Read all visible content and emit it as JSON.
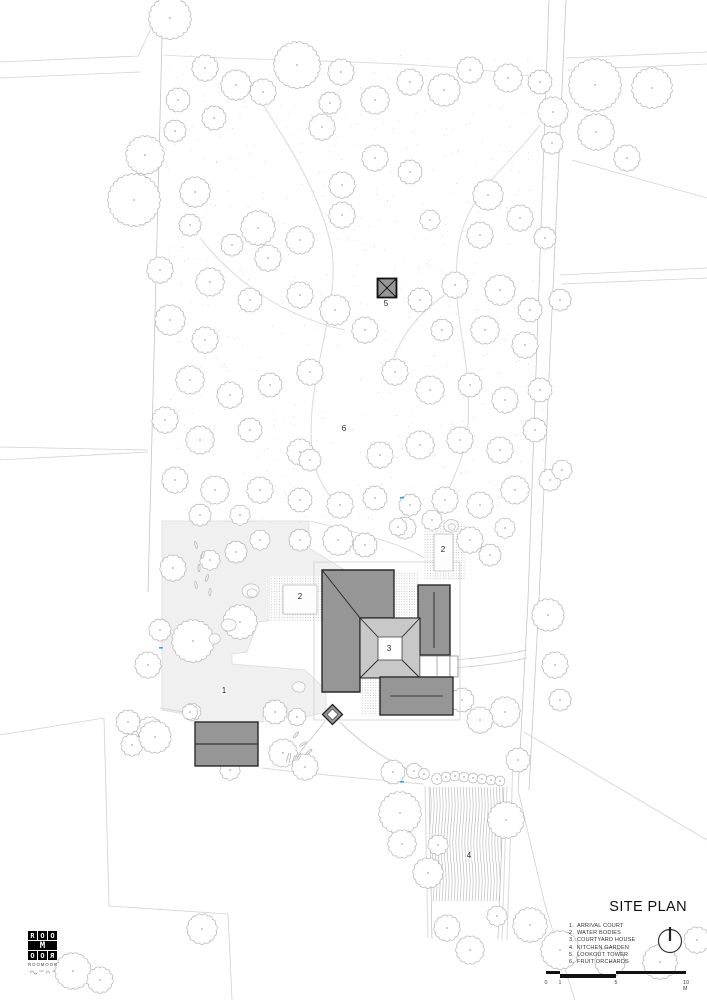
{
  "title_block": {
    "title": "SITE PLAN",
    "legend": [
      {
        "num": "1.",
        "label": "ARRIVAL COURT"
      },
      {
        "num": "2.",
        "label": "WATER BODIES"
      },
      {
        "num": "3.",
        "label": "COURTYARD HOUSE"
      },
      {
        "num": "4.",
        "label": "KITCHEN GARDEN"
      },
      {
        "num": "5.",
        "label": "LOOKOUT TOWER"
      },
      {
        "num": "6.",
        "label": "FRUIT ORCHARDS"
      }
    ],
    "scale_bar": {
      "ticks": [
        {
          "text": "0",
          "x": 0
        },
        {
          "text": "1",
          "x": 14
        },
        {
          "text": "5",
          "x": 70
        },
        {
          "text": "10 M",
          "x": 140
        }
      ]
    },
    "north_icon": "north-indicator"
  },
  "logo": {
    "rows": [
      "ROO",
      "M",
      "OOR"
    ],
    "wordmark": "ROOMOOR"
  },
  "plan": {
    "labels": [
      {
        "text": "1",
        "x": 224,
        "y": 691
      },
      {
        "text": "2",
        "x": 300,
        "y": 597
      },
      {
        "text": "2",
        "x": 443,
        "y": 550
      },
      {
        "text": "3",
        "x": 389,
        "y": 649
      },
      {
        "text": "4",
        "x": 469,
        "y": 856
      },
      {
        "text": "5",
        "x": 386,
        "y": 304
      },
      {
        "text": "6",
        "x": 344,
        "y": 429
      }
    ],
    "colors": {
      "roof_dark": "#ababab",
      "roof_outline": "#2a2a2a",
      "tree_line": "#b5b5b5",
      "context_line": "#d2d2d2",
      "court_fill": "#f0f0f0",
      "survey_mark": "#29abe2"
    },
    "survey_marks": [
      [
        159,
        647
      ],
      [
        400,
        497
      ],
      [
        400,
        781
      ]
    ],
    "trees": [
      [
        170,
        18,
        20
      ],
      [
        205,
        68,
        12
      ],
      [
        178,
        100,
        11
      ],
      [
        236,
        85,
        14
      ],
      [
        263,
        92,
        12
      ],
      [
        297,
        65,
        22
      ],
      [
        341,
        72,
        12
      ],
      [
        330,
        103,
        10
      ],
      [
        214,
        118,
        11
      ],
      [
        175,
        131,
        10
      ],
      [
        375,
        100,
        13
      ],
      [
        410,
        82,
        12
      ],
      [
        444,
        90,
        15
      ],
      [
        470,
        70,
        12
      ],
      [
        508,
        78,
        13
      ],
      [
        540,
        82,
        11
      ],
      [
        553,
        112,
        14
      ],
      [
        595,
        85,
        25
      ],
      [
        652,
        88,
        19
      ],
      [
        596,
        132,
        17
      ],
      [
        552,
        143,
        10
      ],
      [
        627,
        158,
        12
      ],
      [
        145,
        155,
        18
      ],
      [
        195,
        192,
        14
      ],
      [
        134,
        200,
        25
      ],
      [
        190,
        225,
        10
      ],
      [
        258,
        228,
        16
      ],
      [
        342,
        185,
        12
      ],
      [
        322,
        127,
        12
      ],
      [
        375,
        158,
        12
      ],
      [
        410,
        172,
        11
      ],
      [
        342,
        215,
        12
      ],
      [
        300,
        240,
        13
      ],
      [
        268,
        258,
        12
      ],
      [
        232,
        245,
        10
      ],
      [
        488,
        195,
        14
      ],
      [
        520,
        218,
        12
      ],
      [
        545,
        238,
        10
      ],
      [
        480,
        235,
        12
      ],
      [
        430,
        220,
        9
      ],
      [
        160,
        270,
        12
      ],
      [
        210,
        282,
        13
      ],
      [
        250,
        300,
        11
      ],
      [
        300,
        295,
        12
      ],
      [
        335,
        310,
        14
      ],
      [
        365,
        330,
        12
      ],
      [
        420,
        300,
        11
      ],
      [
        455,
        285,
        12
      ],
      [
        500,
        290,
        14
      ],
      [
        530,
        310,
        11
      ],
      [
        170,
        320,
        14
      ],
      [
        205,
        340,
        12
      ],
      [
        485,
        330,
        13
      ],
      [
        525,
        345,
        12
      ],
      [
        560,
        300,
        10
      ],
      [
        442,
        330,
        10
      ],
      [
        190,
        380,
        13
      ],
      [
        230,
        395,
        12
      ],
      [
        270,
        385,
        11
      ],
      [
        310,
        372,
        12
      ],
      [
        395,
        372,
        12
      ],
      [
        430,
        390,
        13
      ],
      [
        470,
        385,
        11
      ],
      [
        505,
        400,
        12
      ],
      [
        540,
        390,
        11
      ],
      [
        165,
        420,
        12
      ],
      [
        200,
        440,
        13
      ],
      [
        250,
        430,
        11
      ],
      [
        300,
        452,
        12
      ],
      [
        310,
        460,
        10
      ],
      [
        380,
        455,
        12
      ],
      [
        420,
        445,
        13
      ],
      [
        460,
        440,
        12
      ],
      [
        500,
        450,
        12
      ],
      [
        535,
        430,
        11
      ],
      [
        175,
        480,
        12
      ],
      [
        215,
        490,
        13
      ],
      [
        260,
        490,
        12
      ],
      [
        300,
        500,
        11
      ],
      [
        340,
        505,
        12
      ],
      [
        375,
        498,
        11
      ],
      [
        410,
        505,
        10
      ],
      [
        445,
        500,
        12
      ],
      [
        480,
        505,
        12
      ],
      [
        515,
        490,
        13
      ],
      [
        550,
        480,
        10
      ],
      [
        200,
        515,
        10
      ],
      [
        240,
        515,
        9
      ],
      [
        405,
        528,
        10
      ],
      [
        432,
        520,
        9
      ],
      [
        562,
        470,
        9
      ],
      [
        236,
        552,
        10
      ],
      [
        260,
        540,
        9
      ],
      [
        210,
        560,
        9
      ],
      [
        338,
        540,
        14
      ],
      [
        300,
        540,
        10
      ],
      [
        365,
        545,
        11
      ],
      [
        398,
        527,
        8
      ],
      [
        470,
        540,
        12
      ],
      [
        490,
        555,
        10
      ],
      [
        505,
        528,
        9
      ],
      [
        240,
        622,
        16
      ],
      [
        193,
        641,
        20
      ],
      [
        160,
        630,
        10
      ],
      [
        148,
        665,
        12
      ],
      [
        173,
        568,
        12
      ],
      [
        548,
        615,
        15
      ],
      [
        555,
        665,
        12
      ],
      [
        505,
        712,
        14
      ],
      [
        560,
        700,
        10
      ],
      [
        275,
        712,
        11
      ],
      [
        297,
        717,
        8
      ],
      [
        283,
        753,
        13
      ],
      [
        305,
        767,
        12
      ],
      [
        230,
        770,
        9
      ],
      [
        192,
        712,
        8
      ],
      [
        150,
        730,
        12
      ],
      [
        132,
        745,
        10
      ],
      [
        462,
        700,
        11
      ],
      [
        480,
        720,
        12
      ],
      [
        393,
        772,
        11
      ],
      [
        400,
        813,
        20
      ],
      [
        402,
        844,
        13
      ],
      [
        428,
        873,
        14
      ],
      [
        438,
        845,
        9
      ],
      [
        506,
        820,
        17
      ],
      [
        497,
        916,
        9
      ],
      [
        447,
        928,
        12
      ],
      [
        470,
        950,
        13
      ],
      [
        530,
        925,
        16
      ],
      [
        518,
        760,
        11
      ],
      [
        560,
        950,
        18
      ],
      [
        610,
        962,
        14
      ],
      [
        660,
        962,
        16
      ],
      [
        697,
        940,
        12
      ],
      [
        128,
        722,
        11
      ],
      [
        155,
        737,
        15
      ],
      [
        190,
        712,
        7
      ],
      [
        202,
        929,
        14
      ],
      [
        73,
        971,
        17
      ],
      [
        100,
        980,
        12
      ],
      [
        437,
        779,
        5
      ],
      [
        446,
        777,
        4.5
      ],
      [
        455,
        776,
        4.5
      ],
      [
        464,
        777,
        4.5
      ],
      [
        473,
        778,
        4.5
      ],
      [
        482,
        779,
        4.5
      ],
      [
        491,
        780,
        4.5
      ],
      [
        500,
        781,
        4.5
      ],
      [
        414,
        771,
        7
      ],
      [
        424,
        774,
        5
      ]
    ]
  }
}
